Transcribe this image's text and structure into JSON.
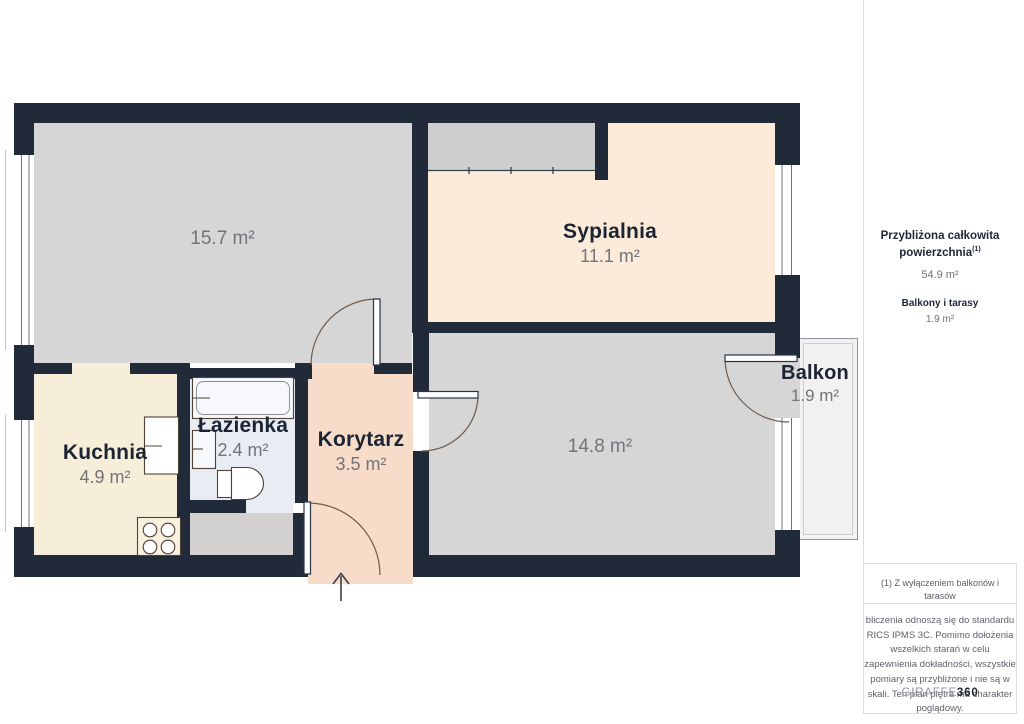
{
  "floor_plan": {
    "rooms": {
      "living": {
        "area": "15.7 m²"
      },
      "bedroom": {
        "name": "Sypialnia",
        "area": "11.1 m²"
      },
      "kitchen": {
        "name": "Kuchnia",
        "area": "4.9 m²"
      },
      "bathroom": {
        "name": "Łazienka",
        "area": "2.4 m²"
      },
      "corridor": {
        "name": "Korytarz",
        "area": "3.5 m²"
      },
      "room": {
        "area": "14.8 m²"
      },
      "balcony": {
        "name": "Balkon",
        "area": "1.9 m²"
      }
    },
    "colors": {
      "wall": "#212a39",
      "living": "#d6d6d7",
      "bedroom": "#fcebd9",
      "kitchen": "#f6eed8",
      "bathroom": "#e9ecf3",
      "corridor": "#f6dcc9",
      "balcony": "#f1f1f2"
    }
  },
  "sidebar": {
    "summary": {
      "title": "Przybliżona całkowita powierzchnia",
      "title_ref": "(1)",
      "total_area": "54.9 m²",
      "balconies_label": "Balkony i tarasy",
      "balconies_area": "1.9 m²"
    },
    "footnote": "(1) Z wyłączeniem balkonów i tarasów",
    "disclaimer": "bliczenia odnoszą się do standardu RICS IPMS 3C. Pomimo dołożenia wszelkich starań w celu zapewnienia dokładności, wszystkie pomiary są przybliżone i nie są w skali. Ten plan piętra ma charakter poglądowy.",
    "logo": {
      "name": "GIRAFFE",
      "suffix": "360"
    }
  }
}
